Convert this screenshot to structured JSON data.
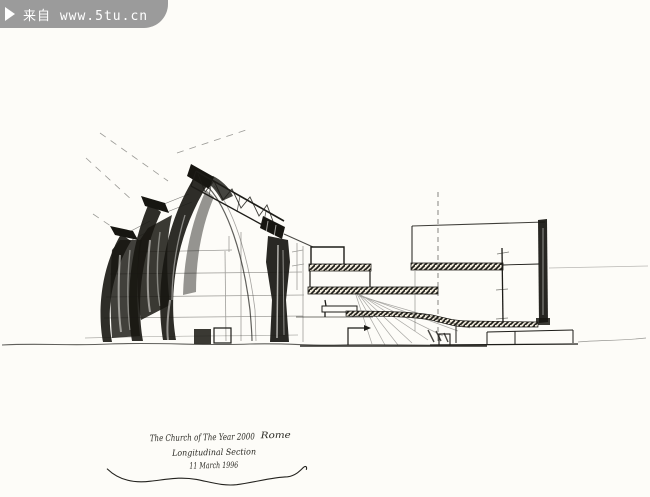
{
  "watermark": {
    "text": "来自 www.5tu.cn",
    "icon": "play-triangle",
    "bg_color": "#9b9b9b",
    "text_color": "#ffffff"
  },
  "sketch": {
    "type": "hand-drawn architectural ink sketch",
    "subject": "longitudinal section of a church with three curved shell walls and stepped building section",
    "ink_color": "#1d1c18",
    "paper_color": "#fdfcf8"
  },
  "caption": {
    "title": "The Church of The Year 2000",
    "location": "Rome",
    "subtitle": "Longitudinal Section",
    "date": "11 March 1996"
  }
}
